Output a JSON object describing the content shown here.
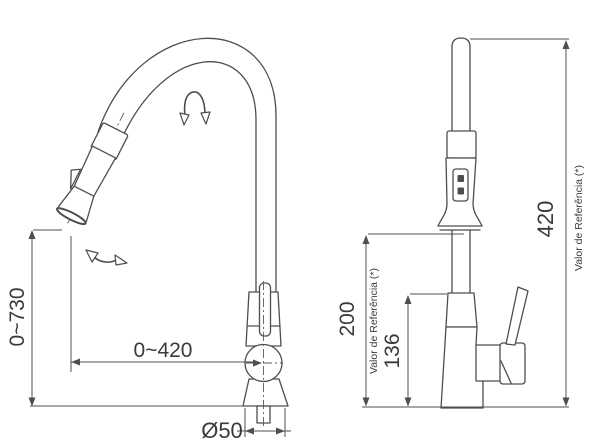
{
  "canvas": {
    "background": "#ffffff",
    "line_color": "#4d4d4d",
    "text_color": "#3a3a3a"
  },
  "front_view": {
    "dim_height_range": "0~730",
    "dim_reach_range": "0~420",
    "dim_base_diameter": "Ø50"
  },
  "side_view": {
    "dim_overall_height": "420",
    "dim_spray_clearance": "200",
    "dim_body_height": "136",
    "reference_note": "Valor de Referência (*)"
  },
  "icons": {
    "rotation_arrow": "spout-rotation-arrow",
    "swivel_arrow": "spray-swivel-arrow"
  }
}
